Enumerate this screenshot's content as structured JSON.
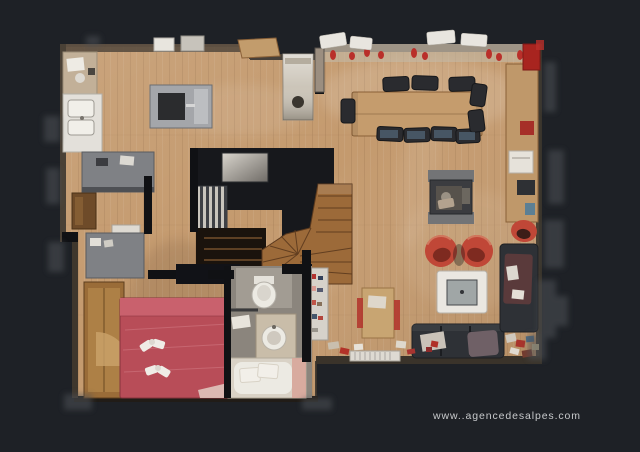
{
  "watermark": {
    "text": "www..agencedesalpes.com"
  },
  "view": {
    "type_label": "3d-dollhouse-floorplan"
  },
  "colors": {
    "background": "#1e2126",
    "floor_wood": "#c49a6e",
    "wall_black": "#101114",
    "counter_white": "#e3e0da",
    "counter_gray": "#7f8185",
    "island_gray": "#a4a6aa",
    "sink_dark": "#2b2c2e",
    "cabinet_brown": "#6e4b29",
    "fridge_steel": "#c9c2b5",
    "table_wood": "#c59c6d",
    "chair_dark": "#2a2b2f",
    "sideboard_wood": "#bf986a",
    "fireplace_gray": "#737476",
    "fireplace_dark": "#3b3c40",
    "armchair_red": "#c04737",
    "armchair_red_dark": "#7e2a20",
    "sofa_dark": "#2e3136",
    "pillow_mauve": "#6f6066",
    "blanket_maroon": "#5a3a3b",
    "coffee_table": "#eae7e1",
    "side_table": "#c8a572",
    "shelf_light": "#d6d2ca",
    "stair_wood": "#9c6a39",
    "stair_void": "#17181c",
    "window_light": "#c9c5bd",
    "wardrobe_wood": "#9a6c38",
    "bed_red": "#b84d58",
    "bed_red_light": "#c9616d",
    "towel_white": "#efece6",
    "bath_floor": "#8b857d",
    "fixture_white": "#eceae3",
    "vanity_tan": "#c9bda9",
    "tub_pink": "#d7a498",
    "radiator_white": "#dedad2",
    "red_accent": "#b92f2a",
    "balcony_white": "#e8e5df",
    "artifact_gray": "#4e5157",
    "watermark_text": "#d6d8da"
  }
}
